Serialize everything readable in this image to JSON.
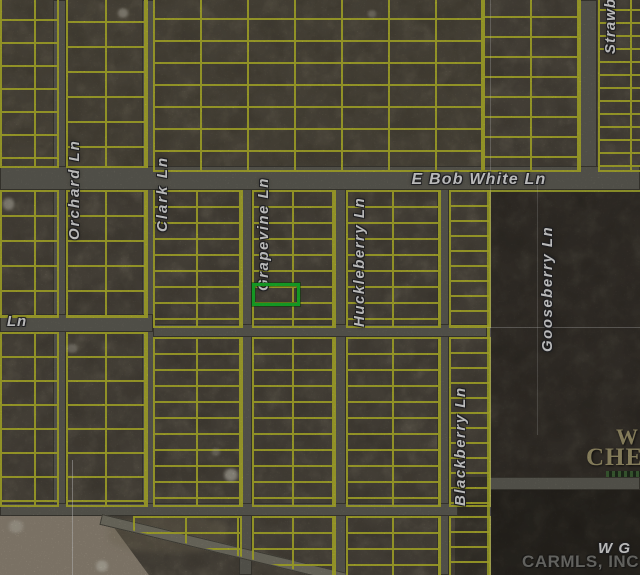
{
  "map": {
    "street_labels": {
      "orchard": "Orchard Ln",
      "clark": "Clark Ln",
      "grapevine": "Grapevine Ln",
      "huckleberry": "Huckleberry Ln",
      "blackberry": "Blackberry Ln",
      "gooseberry": "Gooseberry Ln",
      "strawberry": "Strawberry Ln",
      "e_bob_white": "E Bob White Ln",
      "west_partial": "Ln",
      "south_east_partial": "W G"
    },
    "overlay_text": {
      "subdivision_partial_line1": "W",
      "subdivision_partial_line2": "CHEROKEE",
      "mls_watermark": "CARMLS, INC"
    },
    "highlighted_parcel": {
      "outline_color": "#1dd231"
    },
    "colors": {
      "parcel_line": "#d3d435",
      "road": "#6f6d63",
      "field": "#aa9e8c",
      "woods_base": "#3a332a"
    }
  }
}
